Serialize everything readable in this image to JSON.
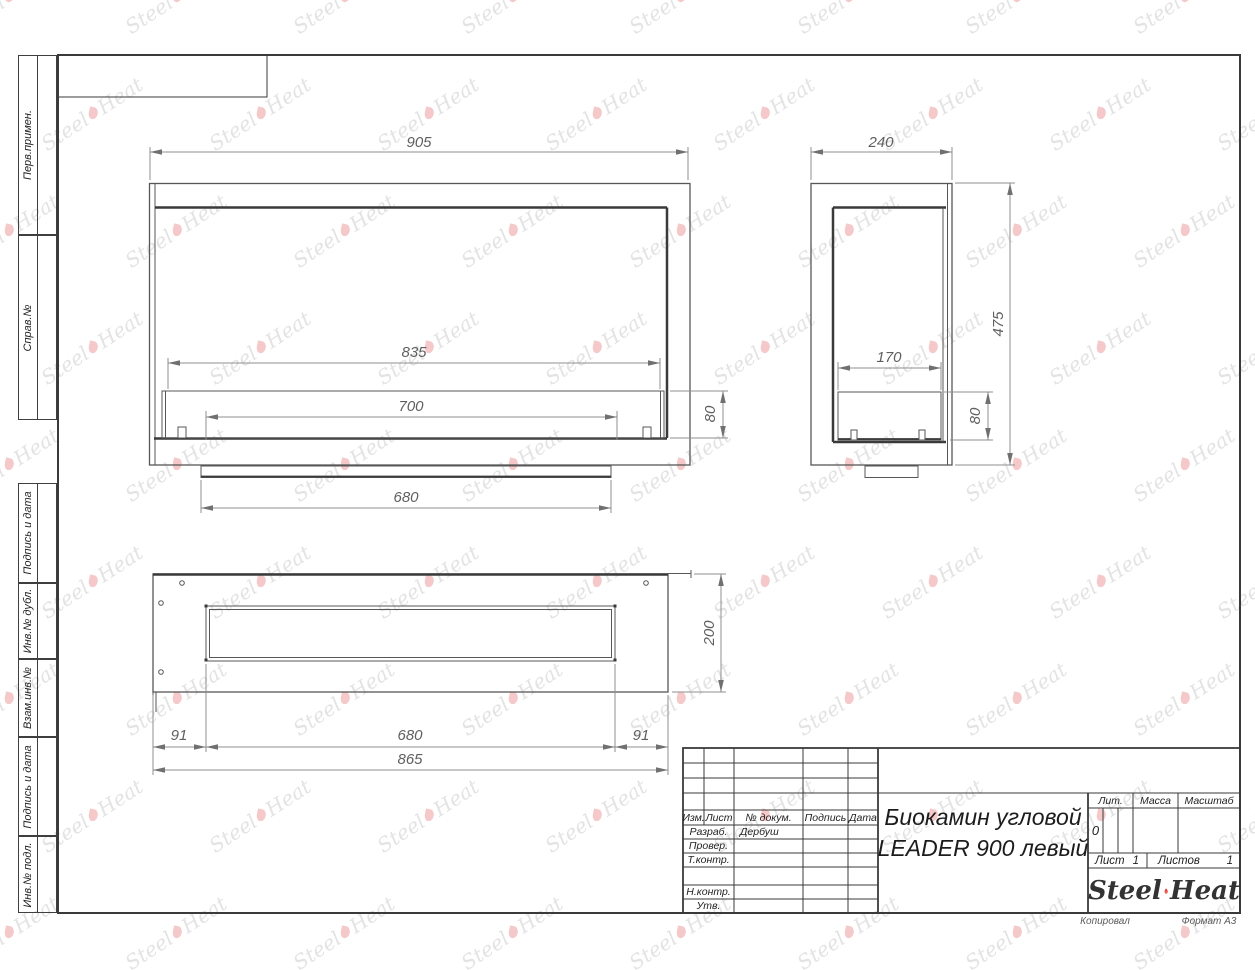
{
  "watermark": {
    "steel": "Steel",
    "heat": "Heat"
  },
  "margin": {
    "items": [
      {
        "label": "Перв.примен."
      },
      {
        "label": "Справ.№"
      },
      {
        "label": "Подпись и дата"
      },
      {
        "label": "Инв.№ дубл."
      },
      {
        "label": "Взам.инв.№"
      },
      {
        "label": "Подпись и дата"
      },
      {
        "label": "Инв.№ подл."
      }
    ]
  },
  "dims": {
    "front": {
      "w905": "905",
      "w835": "835",
      "w700": "700",
      "w680": "680",
      "h80": "80"
    },
    "side": {
      "w240": "240",
      "h475": "475",
      "w170": "170",
      "h80": "80"
    },
    "top": {
      "w865": "865",
      "w680": "680",
      "left91": "91",
      "right91": "91",
      "h200": "200"
    }
  },
  "title_block": {
    "rev_header": {
      "izm": "Изм.",
      "list": "Лист",
      "doc": "№ докум.",
      "sign": "Подпись",
      "date": "Дата"
    },
    "rows": {
      "razrab": "Разраб.",
      "prover": "Провер.",
      "tkontr": "Т.контр.",
      "nkontr": "Н.контр.",
      "utv": "Утв."
    },
    "developer": "Дербуш",
    "title1": "Биокамин угловой",
    "title2": "LEADER 900 левый",
    "lit_label": "Лит.",
    "mass_label": "Масса",
    "scale_label": "Масштаб",
    "lit_value": "0",
    "sheet_label": "Лист",
    "sheet_value": "1",
    "sheets_label": "Листов",
    "sheets_value": "1",
    "logo": {
      "steel": "Steel",
      "heat": "Heat"
    }
  },
  "page": {
    "copied_label": "Копировал",
    "format_label": "Формат А3"
  }
}
